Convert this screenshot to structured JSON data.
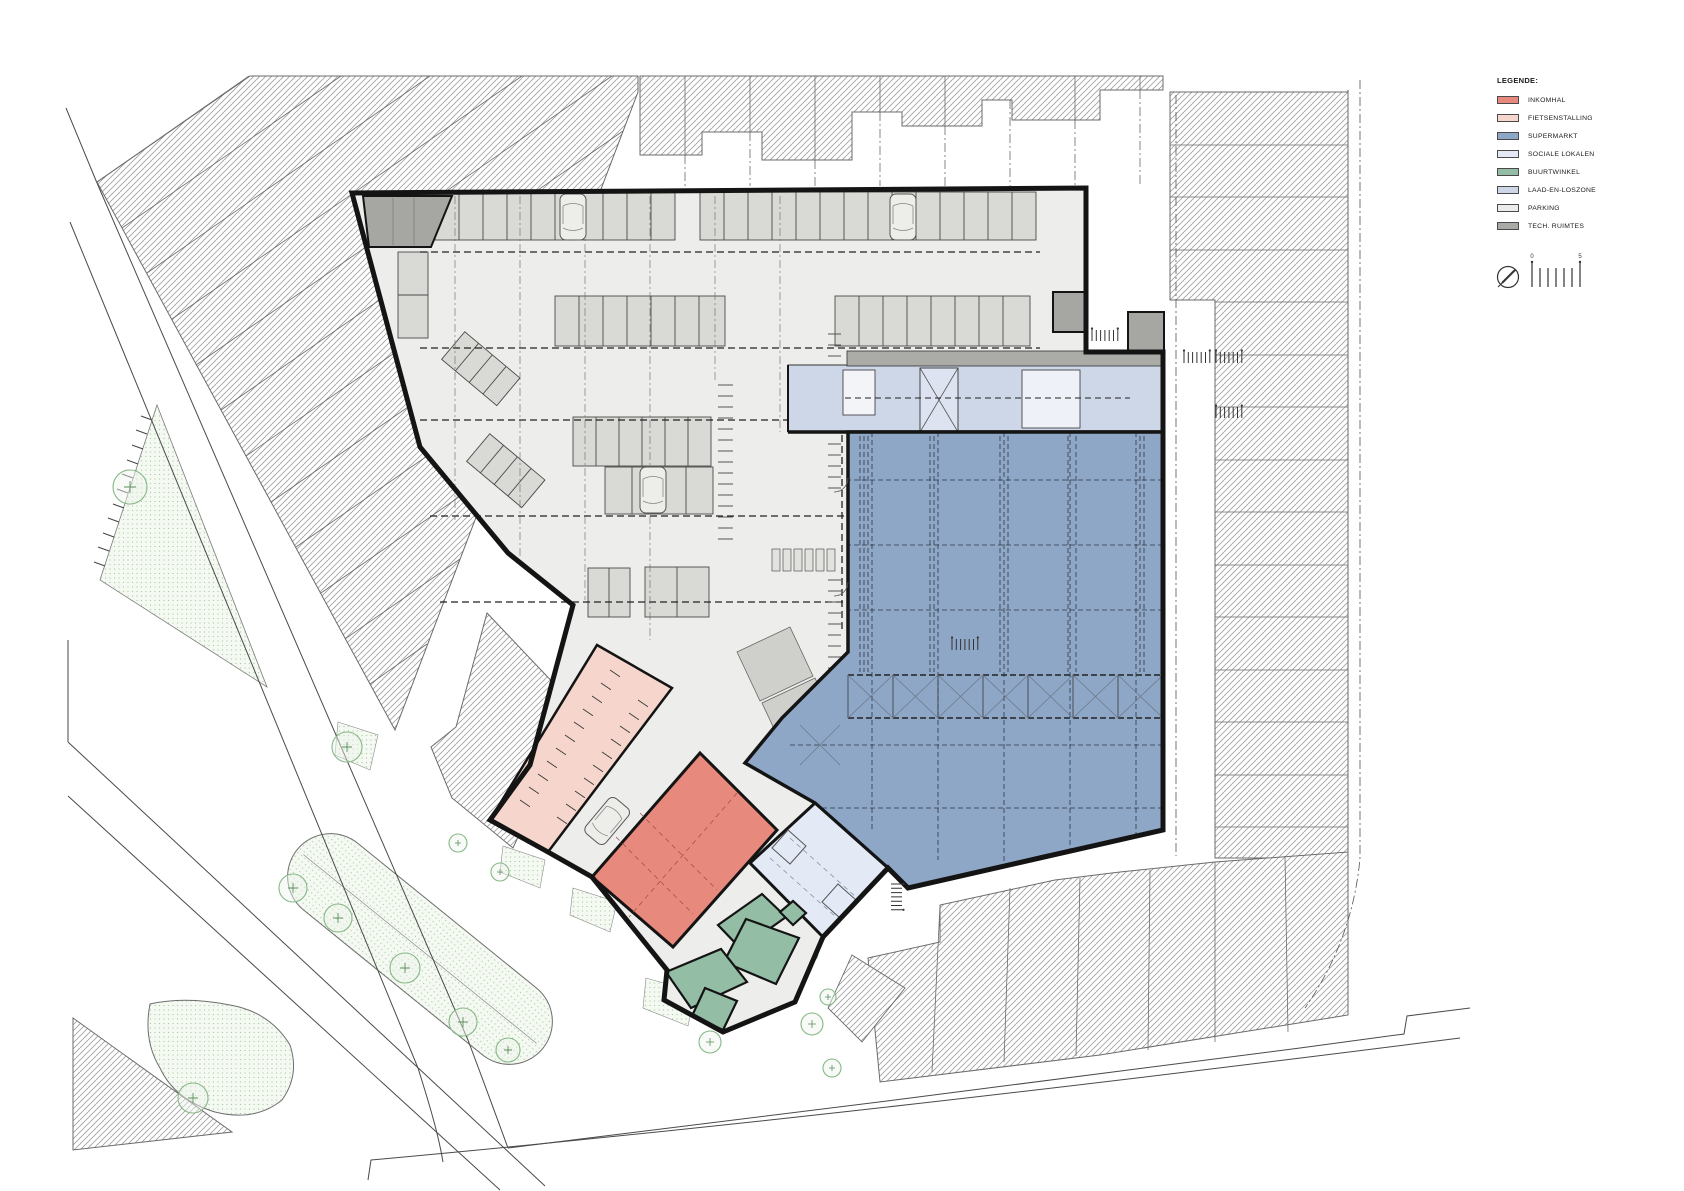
{
  "legend": {
    "title": "LEGENDE:",
    "items": [
      {
        "label": "INKOMHAL",
        "color": "#e8897e"
      },
      {
        "label": "FIETSENSTALLING",
        "color": "#f6d6cc"
      },
      {
        "label": "SUPERMARKT",
        "color": "#8fa7c7"
      },
      {
        "label": "SOCIALE LOKALEN",
        "color": "#e3eaf6"
      },
      {
        "label": "BUURTWINKEL",
        "color": "#93bda5"
      },
      {
        "label": "LAAD-EN-LOSZONE",
        "color": "#cdd7e8"
      },
      {
        "label": "PARKING",
        "color": "#ebebe9"
      },
      {
        "label": "TECH. RUIMTES",
        "color": "#a9a9a6"
      }
    ]
  },
  "scale_bar": {
    "tick_labels": [
      "0",
      "5"
    ]
  },
  "plan_colors": {
    "building_outline": "#141414",
    "parking_fill": "#ededeb",
    "stall_fill": "#d9d9d5",
    "hatch_line": "#a0a0a0",
    "green_area": "#f4f9f2",
    "tree_stroke": "#86b786"
  }
}
